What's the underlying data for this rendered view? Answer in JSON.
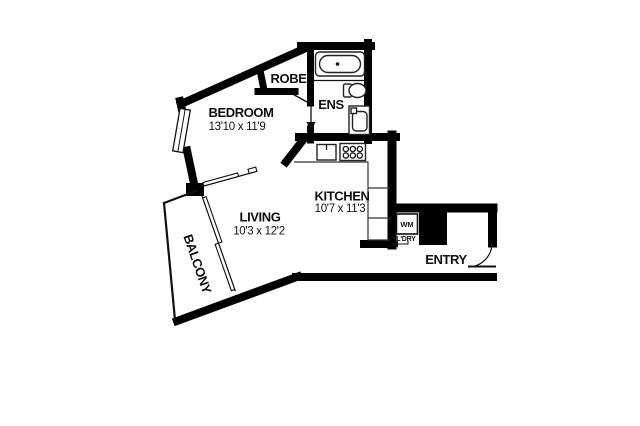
{
  "rooms": {
    "bedroom": {
      "label": "BEDROOM",
      "dimensions": "13'10 x 11'9"
    },
    "living": {
      "label": "LIVING",
      "dimensions": "10'3 x 12'2"
    },
    "kitchen": {
      "label": "KITCHEN",
      "dimensions": "10'7 x 11'3"
    },
    "ensuite": {
      "label": "ENS"
    },
    "robe": {
      "label": "ROBE"
    },
    "balcony": {
      "label": "BALCONY"
    },
    "entry": {
      "label": "ENTRY"
    },
    "laundry": {
      "washer_label": "WM",
      "label": "L'DRY"
    }
  },
  "colors": {
    "wall": "#000000",
    "floor": "#ffffff",
    "line": "#1a1a1a"
  }
}
